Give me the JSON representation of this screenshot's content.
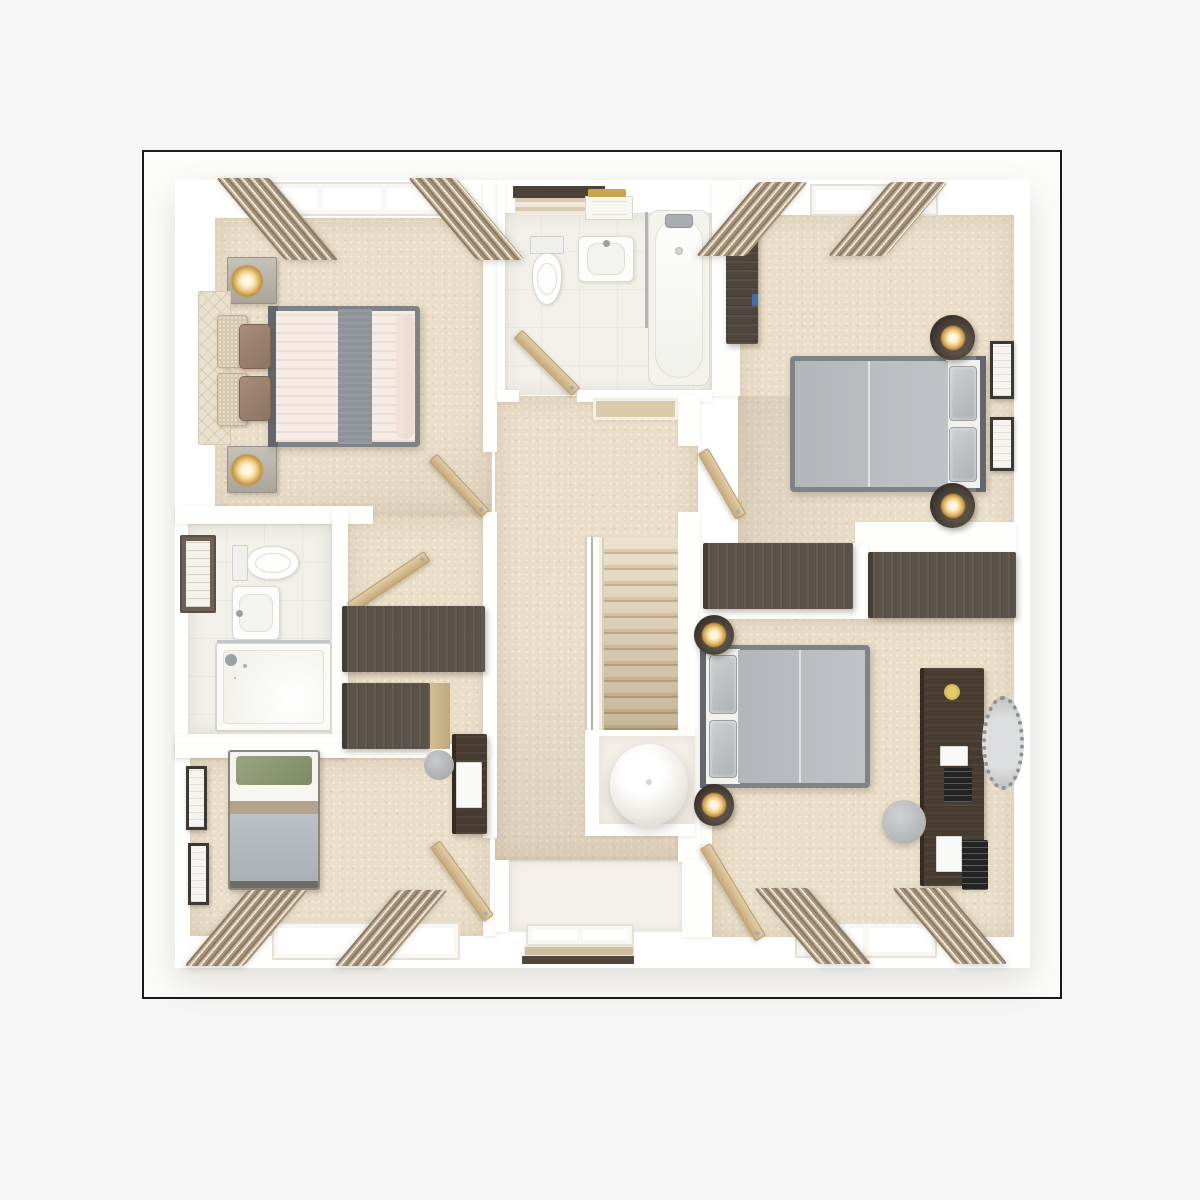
{
  "image_kind": "3d-floor-plan-render",
  "palette": {
    "page_bg": "#f6f6f6",
    "frame_border": "#1a1a1a",
    "frame_bg": "#fcfcfb",
    "wall_white": "#fefefd",
    "carpet_beige": "#eadec9",
    "bathroom_tile": "#f2f0e9",
    "dark_wood": "#5b5249",
    "vanity_wood": "#473b30",
    "light_oak_door": "#d5bb90",
    "bed_gray": "#b6babd",
    "bed_blush": "#f6ece5",
    "bed_runner_gray": "#8e9399",
    "pillow_brown": "#9b8170",
    "pillow_green": "#8f9975",
    "lamp_glow": "#f2cf8d",
    "curtain_taupe": "#c8b69a",
    "window_pane": "#c4c9cc",
    "stair_tread": "#d8c6a4",
    "mirror_silver": "#bfc2c4"
  },
  "legend": "items: n=name, t=type, r=[left,top,width,height] px; v=style variant; g=window pane groups; skew=curtain skewX deg; rot=door rotation deg; head=bed head side",
  "floorplan": {
    "items": [
      {
        "n": "building-footprint",
        "t": "wall",
        "v": "base",
        "r": [
          175,
          180,
          855,
          788
        ]
      },
      {
        "n": "master-bedroom-floor",
        "t": "floor",
        "v": "carpet",
        "r": [
          215,
          218,
          277,
          298
        ]
      },
      {
        "n": "family-bathroom-floor",
        "t": "floor",
        "v": "tile",
        "r": [
          503,
          213,
          209,
          182
        ]
      },
      {
        "n": "bedroom-2-floor",
        "t": "floor",
        "v": "carpet",
        "r": [
          738,
          215,
          276,
          392
        ]
      },
      {
        "n": "landing-floor",
        "t": "floor",
        "v": "carpet",
        "r": [
          495,
          396,
          203,
          466
        ]
      },
      {
        "n": "dressing-area-floor",
        "t": "floor",
        "v": "carpet",
        "r": [
          347,
          516,
          145,
          232
        ]
      },
      {
        "n": "ensuite-floor",
        "t": "floor",
        "v": "tile",
        "r": [
          188,
          524,
          144,
          210
        ]
      },
      {
        "n": "bedroom-4-floor",
        "t": "floor",
        "v": "carpet",
        "r": [
          190,
          758,
          300,
          178
        ]
      },
      {
        "n": "bedroom-3-floor",
        "t": "floor",
        "v": "carpet",
        "r": [
          712,
          617,
          302,
          320
        ]
      },
      {
        "n": "window-alcove-floor",
        "t": "floor",
        "v": "pale",
        "r": [
          508,
          860,
          188,
          72
        ]
      },
      {
        "n": "bedroom-2-light-shade",
        "t": "shade",
        "v": "a",
        "r": [
          738,
          396,
          276,
          211
        ]
      },
      {
        "n": "landing-light-shade",
        "t": "shade",
        "v": "b",
        "r": [
          495,
          640,
          203,
          222
        ]
      },
      {
        "n": "master-light-shade",
        "t": "shade",
        "v": "c",
        "r": [
          215,
          400,
          277,
          116
        ]
      },
      {
        "n": "wall-master-south",
        "t": "wall",
        "r": [
          175,
          506,
          198,
          18
        ]
      },
      {
        "n": "wall-ensuite-east",
        "t": "wall",
        "r": [
          332,
          506,
          16,
          252
        ]
      },
      {
        "n": "wall-ensuite-south",
        "t": "wall",
        "r": [
          175,
          734,
          172,
          24
        ]
      },
      {
        "n": "wall-landing-west-upper",
        "t": "wall",
        "r": [
          483,
          180,
          14,
          272
        ]
      },
      {
        "n": "wall-landing-west-lower",
        "t": "wall",
        "r": [
          483,
          512,
          14,
          326
        ]
      },
      {
        "n": "wall-bed4-door-stub",
        "t": "wall",
        "r": [
          483,
          916,
          14,
          20
        ]
      },
      {
        "n": "wall-bath-west",
        "t": "wall",
        "r": [
          497,
          180,
          8,
          216
        ]
      },
      {
        "n": "wall-bath-east",
        "t": "wall",
        "r": [
          712,
          180,
          28,
          216
        ]
      },
      {
        "n": "wall-bath-south-west",
        "t": "wall",
        "r": [
          497,
          390,
          22,
          12
        ]
      },
      {
        "n": "wall-bath-south-east",
        "t": "wall",
        "r": [
          577,
          390,
          135,
          12
        ]
      },
      {
        "n": "wall-landing-east-upper",
        "t": "wall",
        "r": [
          678,
          396,
          22,
          50
        ]
      },
      {
        "n": "wall-landing-east-lower",
        "t": "wall",
        "r": [
          678,
          512,
          22,
          350
        ]
      },
      {
        "n": "wall-bed2-bed3-west",
        "t": "wall",
        "r": [
          700,
          607,
          155,
          12
        ]
      },
      {
        "n": "wall-bed2-bed3-east",
        "t": "wall",
        "r": [
          855,
          522,
          161,
          32
        ]
      },
      {
        "n": "wall-wardrobe-gap",
        "t": "wall",
        "r": [
          853,
          543,
          15,
          76
        ]
      },
      {
        "n": "wall-bed4-north",
        "t": "wall",
        "r": [
          175,
          744,
          315,
          14
        ]
      },
      {
        "n": "wall-alcove-west",
        "t": "wall",
        "r": [
          495,
          860,
          14,
          72
        ]
      },
      {
        "n": "wall-alcove-east",
        "t": "wall",
        "r": [
          682,
          860,
          30,
          77
        ]
      },
      {
        "n": "stair-bulkhead",
        "t": "block",
        "v": "cap",
        "r": [
          593,
          398,
          85,
          22
        ]
      },
      {
        "n": "stair-banister",
        "t": "banister",
        "r": [
          585,
          537,
          17,
          196
        ]
      },
      {
        "n": "staircase",
        "t": "stairs",
        "r": [
          602,
          538,
          76,
          192
        ]
      },
      {
        "n": "stairwell-void-walls",
        "t": "wall",
        "r": [
          585,
          730,
          110,
          106
        ]
      },
      {
        "n": "stairwell-void-floor",
        "t": "floor",
        "v": "pale",
        "r": [
          599,
          736,
          96,
          88
        ]
      },
      {
        "n": "pendant-lamp-sphere",
        "t": "block",
        "v": "sphere",
        "r": [
          610,
          744,
          78,
          82
        ]
      },
      {
        "n": "bath-towel-shelf",
        "t": "block",
        "v": "sheld",
        "r": [
          513,
          186,
          92,
          12
        ]
      },
      {
        "n": "bath-towels",
        "t": "block",
        "v": "towels",
        "r": [
          515,
          198,
          86,
          18
        ]
      },
      {
        "n": "bath-cabinet",
        "t": "block",
        "v": "cabw",
        "r": [
          585,
          196,
          48,
          24
        ]
      },
      {
        "n": "bath-gold-towel",
        "t": "block",
        "v": "gold",
        "r": [
          588,
          189,
          38,
          8
        ]
      },
      {
        "n": "bath-toilet",
        "t": "toilet",
        "v": "down",
        "r": [
          527,
          236,
          40,
          70
        ]
      },
      {
        "n": "bath-sink",
        "t": "sink",
        "v": "top",
        "r": [
          578,
          236,
          56,
          46
        ]
      },
      {
        "n": "bath-shower-screen",
        "t": "block",
        "v": "line",
        "r": [
          645,
          212,
          3,
          116
        ]
      },
      {
        "n": "bathtub",
        "t": "tub",
        "r": [
          648,
          210,
          62,
          176
        ]
      },
      {
        "n": "family-bathroom-door",
        "t": "door",
        "rot": 45,
        "r": [
          518,
          328,
          82,
          12
        ]
      },
      {
        "n": "master-nightstand-north",
        "t": "nstand",
        "r": [
          227,
          257,
          50,
          47
        ]
      },
      {
        "n": "master-nightstand-south",
        "t": "nstand",
        "r": [
          227,
          446,
          50,
          47
        ]
      },
      {
        "n": "master-headboard-quilt",
        "t": "block",
        "v": "quilt",
        "r": [
          198,
          291,
          33,
          154
        ]
      },
      {
        "n": "master-sham-1",
        "t": "block",
        "v": "sham",
        "r": [
          217,
          315,
          31,
          53
        ]
      },
      {
        "n": "master-sham-2",
        "t": "block",
        "v": "sham",
        "r": [
          217,
          373,
          31,
          53
        ]
      },
      {
        "n": "master-bed",
        "t": "bedd",
        "v": "blush",
        "head": "left",
        "r": [
          268,
          306,
          152,
          141
        ]
      },
      {
        "n": "master-pillow-1",
        "t": "block",
        "v": "brownpil",
        "r": [
          239,
          324,
          32,
          45
        ]
      },
      {
        "n": "master-pillow-2",
        "t": "block",
        "v": "brownpil",
        "r": [
          239,
          376,
          32,
          45
        ]
      },
      {
        "n": "ensuite-mirror-cabinet",
        "t": "mircab",
        "r": [
          180,
          535,
          36,
          78
        ]
      },
      {
        "n": "ensuite-toilet",
        "t": "toilet",
        "v": "right",
        "r": [
          232,
          542,
          68,
          42
        ]
      },
      {
        "n": "ensuite-sink",
        "t": "sink",
        "v": "left",
        "r": [
          232,
          586,
          48,
          54
        ]
      },
      {
        "n": "ensuite-shower",
        "t": "shower",
        "r": [
          215,
          642,
          117,
          90
        ]
      },
      {
        "n": "ensuite-door",
        "t": "door",
        "rot": -34,
        "r": [
          350,
          602,
          93,
          12
        ]
      },
      {
        "n": "dressing-wardrobe-1",
        "t": "wardrobe",
        "v": "h",
        "r": [
          342,
          606,
          143,
          66
        ]
      },
      {
        "n": "dressing-wardrobe-2",
        "t": "wardrobe",
        "v": "h",
        "r": [
          342,
          683,
          88,
          66
        ]
      },
      {
        "n": "dressing-side-panel",
        "t": "block",
        "v": "panel",
        "r": [
          430,
          683,
          20,
          66
        ]
      },
      {
        "n": "master-suite-door",
        "t": "door",
        "rot": 47,
        "r": [
          433,
          452,
          77,
          11
        ]
      },
      {
        "n": "bedroom-2-wardrobe",
        "t": "wardrobe",
        "v": "v",
        "r": [
          726,
          226,
          32,
          118
        ]
      },
      {
        "n": "wardrobe-blue-detail",
        "t": "block",
        "v": "blue",
        "r": [
          752,
          294,
          6,
          12
        ]
      },
      {
        "n": "bedroom-2-bed",
        "t": "bedd",
        "v": "gray",
        "head": "right",
        "r": [
          790,
          356,
          196,
          136
        ]
      },
      {
        "n": "bedroom-2-table-north",
        "t": "rtable",
        "r": [
          930,
          315,
          45,
          45
        ]
      },
      {
        "n": "bedroom-2-table-south",
        "t": "rtable",
        "r": [
          930,
          483,
          45,
          45
        ]
      },
      {
        "n": "bedroom-2-art-1",
        "t": "art",
        "r": [
          990,
          341,
          24,
          58
        ]
      },
      {
        "n": "bedroom-2-art-2",
        "t": "art",
        "r": [
          990,
          417,
          24,
          54
        ]
      },
      {
        "n": "bedroom-2-door",
        "t": "door",
        "rot": 60,
        "r": [
          703,
          445,
          76,
          12
        ]
      },
      {
        "n": "built-in-wardrobe-1",
        "t": "wardrobe",
        "v": "h",
        "r": [
          703,
          543,
          150,
          66
        ]
      },
      {
        "n": "built-in-wardrobe-2",
        "t": "wardrobe",
        "v": "h",
        "r": [
          868,
          552,
          148,
          66
        ]
      },
      {
        "n": "bedroom-3-bed",
        "t": "bedd",
        "v": "gray",
        "head": "left",
        "r": [
          700,
          645,
          170,
          143
        ]
      },
      {
        "n": "bedroom-3-table-north",
        "t": "rtable",
        "r": [
          694,
          615,
          40,
          40
        ]
      },
      {
        "n": "bedroom-3-table-south",
        "t": "rtable",
        "r": [
          694,
          784,
          40,
          42
        ]
      },
      {
        "n": "bedroom-3-vanity-desk",
        "t": "wardrobe",
        "v": "vd",
        "r": [
          920,
          668,
          64,
          218
        ]
      },
      {
        "n": "vanity-flower",
        "t": "block",
        "v": "gold2",
        "r": [
          944,
          684,
          16,
          16
        ]
      },
      {
        "n": "vanity-paper",
        "t": "block",
        "v": "paper",
        "r": [
          940,
          746,
          28,
          20
        ]
      },
      {
        "n": "vanity-tablet",
        "t": "block",
        "v": "dark",
        "r": [
          944,
          768,
          28,
          34
        ]
      },
      {
        "n": "desk-paper",
        "t": "block",
        "v": "paper",
        "r": [
          936,
          836,
          26,
          36
        ]
      },
      {
        "n": "desk-laptop",
        "t": "block",
        "v": "dark",
        "r": [
          962,
          840,
          26,
          50
        ]
      },
      {
        "n": "vanity-mirror",
        "t": "block",
        "v": "moval",
        "r": [
          982,
          696,
          42,
          94
        ]
      },
      {
        "n": "bedroom-3-pouf",
        "t": "block",
        "v": "pouf",
        "r": [
          882,
          800,
          44,
          44
        ]
      },
      {
        "n": "bedroom-3-door",
        "t": "door",
        "rot": 59,
        "r": [
          705,
          840,
          108,
          12
        ]
      },
      {
        "n": "bedroom-4-bed",
        "t": "beds",
        "r": [
          228,
          750,
          92,
          140
        ]
      },
      {
        "n": "bedroom-4-art-1",
        "t": "art",
        "r": [
          186,
          766,
          21,
          64
        ]
      },
      {
        "n": "bedroom-4-art-2",
        "t": "art",
        "r": [
          188,
          843,
          21,
          62
        ]
      },
      {
        "n": "bedroom-4-desk",
        "t": "wardrobe",
        "v": "vd",
        "r": [
          452,
          734,
          35,
          100
        ]
      },
      {
        "n": "bedroom-4-desk-laptop",
        "t": "block",
        "v": "paper",
        "r": [
          456,
          762,
          26,
          46
        ]
      },
      {
        "n": "bedroom-4-stool",
        "t": "block",
        "v": "stool",
        "r": [
          424,
          750,
          30,
          30
        ]
      },
      {
        "n": "bedroom-4-door",
        "t": "door",
        "rot": 54,
        "r": [
          435,
          838,
          92,
          12
        ]
      },
      {
        "n": "master-window",
        "t": "window",
        "g": 3,
        "r": [
          254,
          182,
          196,
          34
        ]
      },
      {
        "n": "master-curtain-left",
        "t": "curtain",
        "skew": 40,
        "r": [
          216,
          178,
          54,
          82
        ]
      },
      {
        "n": "master-curtain-right",
        "t": "curtain",
        "skew": 40,
        "r": [
          408,
          178,
          48,
          82
        ]
      },
      {
        "n": "bedroom-2-window",
        "t": "window",
        "g": 2,
        "r": [
          810,
          184,
          128,
          32
        ]
      },
      {
        "n": "bedroom-2-curtain-left",
        "t": "curtain",
        "skew": -40,
        "r": [
          758,
          182,
          50,
          74
        ]
      },
      {
        "n": "bedroom-2-curtain-right",
        "t": "curtain",
        "skew": -40,
        "r": [
          890,
          182,
          58,
          74
        ]
      },
      {
        "n": "bedroom-4-window",
        "t": "window",
        "g": 2,
        "r": [
          272,
          922,
          188,
          38
        ]
      },
      {
        "n": "bedroom-4-curtain-left",
        "t": "curtain",
        "skew": -40,
        "r": [
          248,
          890,
          60,
          76
        ]
      },
      {
        "n": "bedroom-4-curtain-right",
        "t": "curtain",
        "skew": -40,
        "r": [
          398,
          890,
          50,
          76
        ]
      },
      {
        "n": "bedroom-3-window",
        "t": "window",
        "g": 2,
        "r": [
          795,
          922,
          142,
          36
        ]
      },
      {
        "n": "bedroom-3-curtain-left",
        "t": "curtain",
        "skew": 40,
        "r": [
          754,
          888,
          54,
          76
        ]
      },
      {
        "n": "bedroom-3-curtain-right",
        "t": "curtain",
        "skew": 40,
        "r": [
          892,
          888,
          52,
          76
        ]
      },
      {
        "n": "landing-window",
        "t": "window",
        "g": 2,
        "r": [
          526,
          924,
          108,
          22
        ]
      },
      {
        "n": "landing-window-shelf",
        "t": "block",
        "v": "tan",
        "r": [
          524,
          946,
          110,
          10
        ]
      },
      {
        "n": "landing-window-base",
        "t": "block",
        "v": "based",
        "r": [
          522,
          956,
          112,
          8
        ]
      }
    ]
  }
}
